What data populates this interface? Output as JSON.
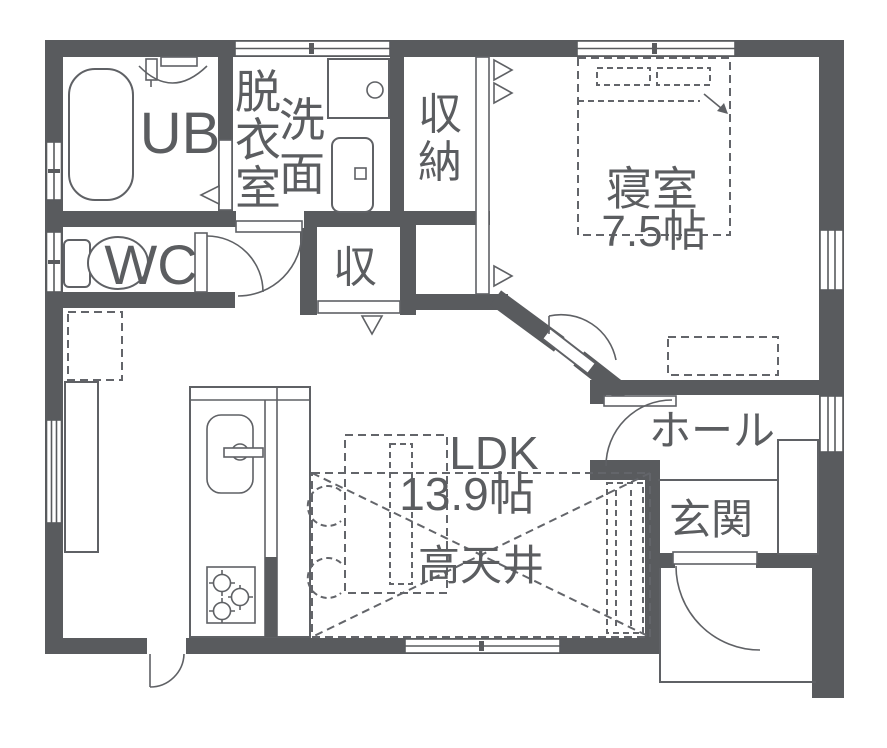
{
  "floorplan": {
    "background_color": "#ffffff",
    "wall_color": "#595b5e",
    "line_color": "#5f6165",
    "text_color": "#5b5d60",
    "rooms": {
      "ub": {
        "label": "UB"
      },
      "dressing_room": {
        "label": "脱衣室"
      },
      "washroom": {
        "label": "洗面"
      },
      "storage_closet": {
        "label": "収納"
      },
      "wc": {
        "label": "WC"
      },
      "small_closet": {
        "label": "収"
      },
      "bedroom": {
        "label": "寝室",
        "size": "7.5帖"
      },
      "hall": {
        "label": "ホール"
      },
      "entrance": {
        "label": "玄関"
      },
      "ldk": {
        "label": "LDK",
        "size": "13.9帖",
        "feature": "高天井"
      }
    },
    "fixtures": [
      "bathtub",
      "bath-counter",
      "toilet",
      "washbasin-counter",
      "washing-machine",
      "kitchen-sink",
      "gas-stove",
      "kitchen-counter",
      "side-counter",
      "refrigerator-space-dashed",
      "dining-table-dashed",
      "chairs-dashed",
      "bed-dashed",
      "dresser-dashed",
      "tv-board-dashed",
      "high-ceiling-cross",
      "shoe-cabinet",
      "entrance-porch"
    ],
    "door_symbols": [
      "swing-door-arc",
      "sliding-door-triangle",
      "window-double-line"
    ]
  }
}
